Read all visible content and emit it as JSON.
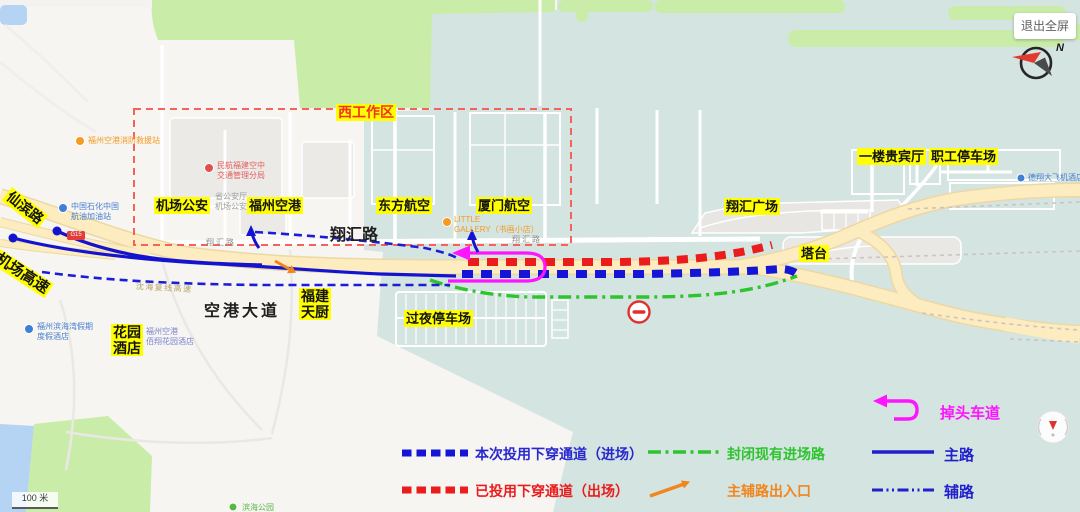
{
  "controls": {
    "exit_fullscreen": "退出全屏",
    "north_label": "N",
    "scale_label": "100 米"
  },
  "work_area": {
    "label": "西工作区"
  },
  "roads": {
    "xianbin": "仙滨路",
    "airport_expressway": "机场高速",
    "konggang_avenue": "空港大道",
    "xianghui_road": "翔汇路",
    "xianghui_small_left": "翔汇路",
    "xianghui_small_mid": "翔汇路",
    "expressway_name": "沈海复线高速",
    "highway_badge": "G15"
  },
  "landmarks": {
    "airport_police": "机场公安",
    "fuzhou_airport": "福州空港",
    "eastern_airlines": "东方航空",
    "xiamen_airlines": "厦门航空",
    "vip_hall": "一楼贵宾厅",
    "staff_parking": "职工停车场",
    "xianghui_plaza": "翔汇广场",
    "tower": "塔台",
    "overnight_parking": "过夜停车场",
    "fujian_tianchu_line1": "福建",
    "fujian_tianchu_line2": "天厨",
    "garden_hotel_line1": "花园",
    "garden_hotel_line2": "酒店"
  },
  "pois": {
    "fire_station": "福州空港消防救援站",
    "sinopec_line1": "中国石化中国",
    "sinopec_line2": "航油加油站",
    "atc_line1": "民航福建空中",
    "atc_line2": "交通管理分局",
    "police_gray_line1": "省公安厅",
    "police_gray_line2": "机场公安局",
    "gallery_line1": "LITTLE",
    "gallery_line2": "GALLERY（书画小店）",
    "hotel_right": "德翔大飞机酒店",
    "resort_line1": "福州滨海湾假期",
    "resort_line2": "度假酒店",
    "baixiang_line1": "福州空港",
    "baixiang_line2": "佰翔花园酒店",
    "green_poi": "滨海公园"
  },
  "legend": {
    "new_tunnel": "本次投用下穿通道（进场）",
    "old_tunnel": "已投用下穿通道（出场）",
    "closed_road": "封闭现有进场路",
    "ramp": "主辅路出入口",
    "uturn": "掉头车道",
    "main_road": "主路",
    "aux_road": "辅路"
  },
  "colors": {
    "new_tunnel_blue": "#1515d8",
    "old_tunnel_red": "#ea1c1c",
    "closed_green": "#2ec42e",
    "ramp_orange": "#f0861e",
    "uturn_magenta": "#ff14ff",
    "highlight_yellow": "#ffff00",
    "work_area_red": "#f4625a"
  }
}
